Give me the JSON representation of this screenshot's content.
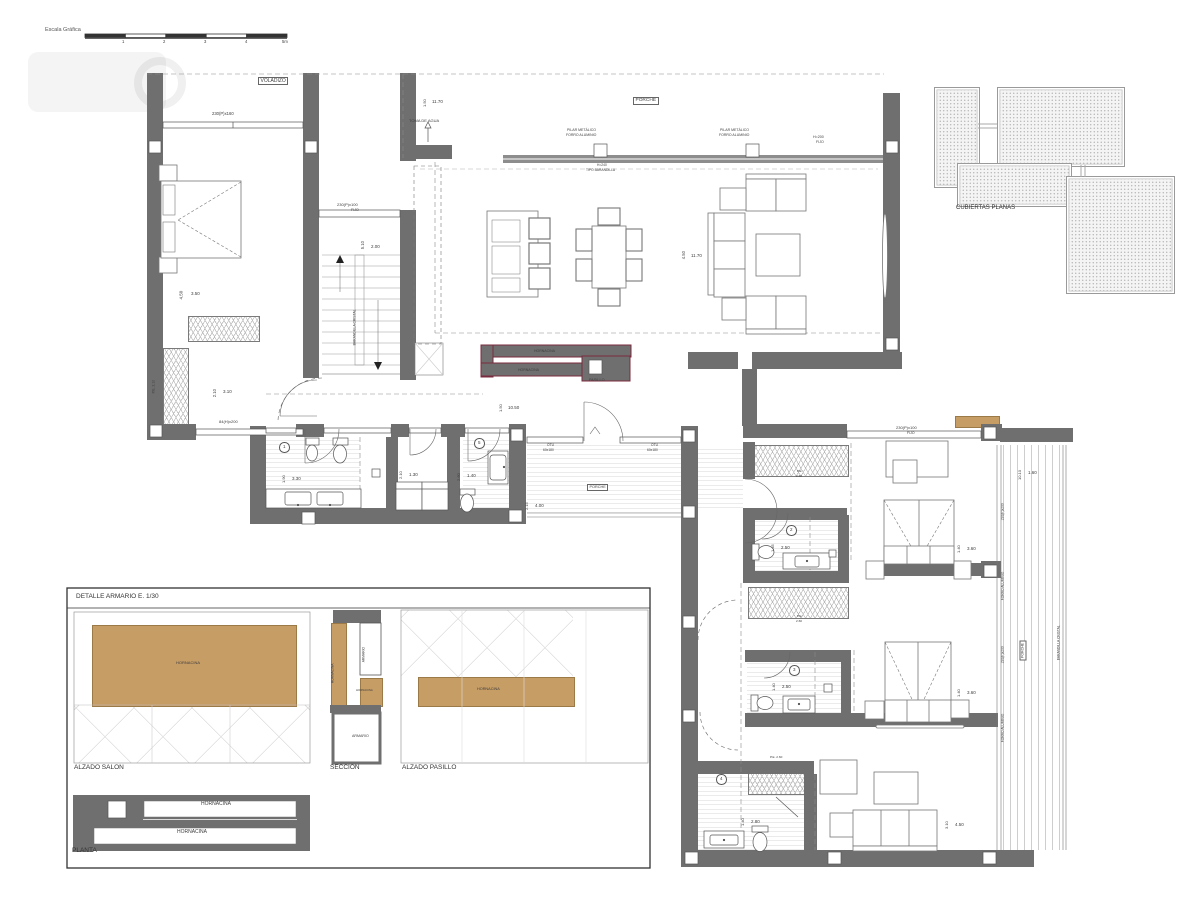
{
  "scale_bar": {
    "label": "Escala Gráfica"
  },
  "key_plan": {
    "title": "CUBIERTAS PLANAS"
  },
  "detail_panel": {
    "title": "DETALLE ARMARIO E. 1/30",
    "alzado_salon": "ALZADO SALON",
    "seccion": "SECCION",
    "alzado_pasillo": "ALZADO PASILLO",
    "planta": "PLANTA"
  },
  "colors": {
    "wall": "#6f6f6f",
    "hornacina_wood": "#c79d66",
    "hornacina_outline": "#7a2b3f"
  },
  "annotations": [
    {
      "id": "voladizo",
      "t": "VOLADIZO",
      "x": 258,
      "y": 77,
      "fs": 5,
      "b": 1
    },
    {
      "id": "win-master",
      "t": "230(P)x160",
      "x": 212,
      "y": 112,
      "fs": 4.2
    },
    {
      "t": "4.50",
      "x": 184,
      "y": 299,
      "fs": 4.5,
      "r": -90
    },
    {
      "t": "3.50",
      "x": 191,
      "y": 292,
      "fs": 4.5
    },
    {
      "t": "P.E. 2.10",
      "x": 156,
      "y": 393,
      "fs": 3.4,
      "r": -90
    },
    {
      "t": "2.10",
      "x": 217,
      "y": 397,
      "fs": 4.2,
      "r": -90
    },
    {
      "t": "3.10",
      "x": 223,
      "y": 390,
      "fs": 4.5
    },
    {
      "t": "84(H)x200",
      "x": 219,
      "y": 420,
      "fs": 4
    },
    {
      "t": "230(P)x100",
      "x": 337,
      "y": 203,
      "fs": 4
    },
    {
      "t": "FIJO",
      "x": 351,
      "y": 209,
      "fs": 3.6
    },
    {
      "t": "5.10",
      "x": 365,
      "y": 249,
      "fs": 4.2,
      "r": -90
    },
    {
      "t": "2.00",
      "x": 371,
      "y": 245,
      "fs": 4.5
    },
    {
      "id": "stair-rail",
      "t": "BARANDILLA CRISTAL",
      "x": 357,
      "y": 345,
      "fs": 3.4,
      "r": -90
    },
    {
      "id": "toma-de-agua",
      "t": "TOMA DE AGUA",
      "x": 409,
      "y": 119,
      "fs": 4
    },
    {
      "t": "1.50",
      "x": 427,
      "y": 107,
      "fs": 4,
      "r": -90
    },
    {
      "t": "11.70",
      "x": 432,
      "y": 100,
      "fs": 4.5
    },
    {
      "id": "porche-top",
      "t": "PORCHE",
      "x": 633,
      "y": 97,
      "fs": 4.8,
      "b": 1
    },
    {
      "t": "PILAR METÁLICO",
      "x": 567,
      "y": 129,
      "fs": 3.5
    },
    {
      "t": "FORRO ALUMINIO",
      "x": 566,
      "y": 134,
      "fs": 3.5
    },
    {
      "t": "PILAR METÁLICO",
      "x": 720,
      "y": 129,
      "fs": 3.5
    },
    {
      "t": "FORRO ALUMINIO",
      "x": 719,
      "y": 134,
      "fs": 3.5
    },
    {
      "t": "H=200",
      "x": 813,
      "y": 136,
      "fs": 3.6
    },
    {
      "t": "FIJO",
      "x": 816,
      "y": 141,
      "fs": 3.6
    },
    {
      "t": "H=240",
      "x": 597,
      "y": 164,
      "fs": 3.3
    },
    {
      "t": "TIPO BARANDILLA",
      "x": 586,
      "y": 169,
      "fs": 3.3
    },
    {
      "t": "4.50",
      "x": 686,
      "y": 259,
      "fs": 4.2,
      "r": -90
    },
    {
      "t": "11.70",
      "x": 691,
      "y": 254,
      "fs": 4.5
    },
    {
      "id": "hornacina-plan-1",
      "t": "HORNACINA",
      "x": 534,
      "y": 350,
      "fs": 3.5
    },
    {
      "id": "hornacina-plan-2",
      "t": "HORNACINA",
      "x": 518,
      "y": 369,
      "fs": 3.5
    },
    {
      "id": "pasillo",
      "t": "PASILLO",
      "x": 589,
      "y": 379,
      "fs": 3.8
    },
    {
      "t": "1.50",
      "x": 503,
      "y": 412,
      "fs": 4,
      "r": -90
    },
    {
      "t": "10.50",
      "x": 508,
      "y": 406,
      "fs": 4.5
    },
    {
      "id": "bath-1",
      "t": "1",
      "x": 279,
      "y": 442,
      "fs": 4.5,
      "c": 1
    },
    {
      "t": "1.90",
      "x": 286,
      "y": 483,
      "fs": 4,
      "r": -90
    },
    {
      "t": "3.30",
      "x": 292,
      "y": 477,
      "fs": 4.5
    },
    {
      "t": "2.10",
      "x": 403,
      "y": 479,
      "fs": 4,
      "r": -90
    },
    {
      "t": "1.30",
      "x": 409,
      "y": 473,
      "fs": 4.5
    },
    {
      "id": "bath-5",
      "t": "5",
      "x": 474,
      "y": 438,
      "fs": 4.5,
      "c": 1
    },
    {
      "t": "2.60",
      "x": 461,
      "y": 481,
      "fs": 4,
      "r": -90
    },
    {
      "t": "1.40",
      "x": 467,
      "y": 474,
      "fs": 4.5
    },
    {
      "t": "OTU",
      "x": 547,
      "y": 444,
      "fs": 3.3
    },
    {
      "t": "60x180",
      "x": 543,
      "y": 449,
      "fs": 3.3
    },
    {
      "t": "OTU",
      "x": 651,
      "y": 444,
      "fs": 3.3
    },
    {
      "t": "60x180",
      "x": 647,
      "y": 449,
      "fs": 3.3
    },
    {
      "id": "porche-center",
      "t": "PORCHE",
      "x": 587,
      "y": 484,
      "fs": 3.8,
      "b": 1
    },
    {
      "t": "2.15",
      "x": 529,
      "y": 510,
      "fs": 4,
      "r": -90
    },
    {
      "t": "4.00",
      "x": 535,
      "y": 504,
      "fs": 4.5
    },
    {
      "t": "230(P)x100",
      "x": 896,
      "y": 426,
      "fs": 4
    },
    {
      "t": "FIJO",
      "x": 907,
      "y": 432,
      "fs": 3.5
    },
    {
      "t": "P.E.",
      "x": 797,
      "y": 470,
      "fs": 3.1
    },
    {
      "t": "2.60",
      "x": 796,
      "y": 475,
      "fs": 3.1
    },
    {
      "id": "bath-2",
      "t": "2",
      "x": 786,
      "y": 525,
      "fs": 4.5,
      "c": 1
    },
    {
      "t": "1.45",
      "x": 775,
      "y": 552,
      "fs": 4,
      "r": -90
    },
    {
      "t": "2.50",
      "x": 781,
      "y": 546,
      "fs": 4.5
    },
    {
      "t": "1.40",
      "x": 961,
      "y": 553,
      "fs": 4,
      "r": -90
    },
    {
      "t": "3.60",
      "x": 967,
      "y": 547,
      "fs": 4.5
    },
    {
      "t": "P.E.",
      "x": 797,
      "y": 615,
      "fs": 3.1
    },
    {
      "t": "2.60",
      "x": 796,
      "y": 620,
      "fs": 3.1
    },
    {
      "id": "bath-3",
      "t": "3",
      "x": 789,
      "y": 665,
      "fs": 4.5,
      "c": 1
    },
    {
      "t": "1.40",
      "x": 776,
      "y": 691,
      "fs": 4,
      "r": -90
    },
    {
      "t": "2.50",
      "x": 782,
      "y": 685,
      "fs": 4.5
    },
    {
      "t": "1.40",
      "x": 961,
      "y": 697,
      "fs": 4,
      "r": -90
    },
    {
      "t": "3.60",
      "x": 967,
      "y": 691,
      "fs": 4.5
    },
    {
      "id": "bath-4",
      "t": "4",
      "x": 716,
      "y": 774,
      "fs": 4.5,
      "c": 1
    },
    {
      "t": "P.E. 2.60",
      "x": 770,
      "y": 756,
      "fs": 3.1
    },
    {
      "t": "1.40",
      "x": 745,
      "y": 826,
      "fs": 4,
      "r": -90
    },
    {
      "t": "2.80",
      "x": 751,
      "y": 820,
      "fs": 4.5
    },
    {
      "t": "3.10",
      "x": 949,
      "y": 829,
      "fs": 4,
      "r": -90
    },
    {
      "t": "4.50",
      "x": 955,
      "y": 823,
      "fs": 4.5
    },
    {
      "t": "10.10",
      "x": 1022,
      "y": 480,
      "fs": 4,
      "r": -90
    },
    {
      "t": "1.60",
      "x": 1028,
      "y": 471,
      "fs": 4.5
    },
    {
      "t": "230(P)x200",
      "x": 1005,
      "y": 520,
      "fs": 3.3,
      "r": -90
    },
    {
      "id": "forro-aluminio-1",
      "t": "FORRO ALUMINIO",
      "x": 1005,
      "y": 600,
      "fs": 3.3,
      "r": -90
    },
    {
      "t": "230(P)x200",
      "x": 1005,
      "y": 663,
      "fs": 3.3,
      "r": -90
    },
    {
      "id": "forro-aluminio-2",
      "t": "FORRO ALUMINIO",
      "x": 1005,
      "y": 742,
      "fs": 3.3,
      "r": -90
    },
    {
      "id": "porche-deck",
      "t": "PORCHE",
      "x": 1026,
      "y": 657,
      "fs": 3.5,
      "r": -90,
      "b": 1
    },
    {
      "id": "deck-rail",
      "t": "BARANDILLA CRISTAL",
      "x": 1061,
      "y": 660,
      "fs": 3.3,
      "r": -90
    },
    {
      "id": "hornacina-salon",
      "t": "HORNACINA",
      "x": 176,
      "y": 661,
      "fs": 4
    },
    {
      "t": "HORNACINA",
      "x": 335,
      "y": 683,
      "fs": 3.3,
      "r": -90
    },
    {
      "t": "ARMARIO",
      "x": 366,
      "y": 662,
      "fs": 3.3,
      "r": -90
    },
    {
      "t": "HORNACINA",
      "x": 356,
      "y": 689,
      "fs": 2.8
    },
    {
      "t": "ARMARIO",
      "x": 352,
      "y": 735,
      "fs": 3.6
    },
    {
      "id": "hornacina-pasillo",
      "t": "HORNACINA",
      "x": 477,
      "y": 688,
      "fs": 3.8
    },
    {
      "id": "hornacina-planta-1",
      "t": "HORNACINA",
      "x": 201,
      "y": 802,
      "fs": 5
    },
    {
      "id": "hornacina-planta-2",
      "t": "HORNACINA",
      "x": 177,
      "y": 830,
      "fs": 5
    },
    {
      "id": "scale-1",
      "t": "1",
      "x": 122,
      "y": 40,
      "fs": 4.2
    },
    {
      "id": "scale-2",
      "t": "2",
      "x": 163,
      "y": 40,
      "fs": 4.2
    },
    {
      "id": "scale-3",
      "t": "3",
      "x": 204,
      "y": 40,
      "fs": 4.2
    },
    {
      "id": "scale-4",
      "t": "4",
      "x": 245,
      "y": 40,
      "fs": 4.2
    },
    {
      "id": "scale-5",
      "t": "5m",
      "x": 282,
      "y": 40,
      "fs": 4.2
    }
  ]
}
